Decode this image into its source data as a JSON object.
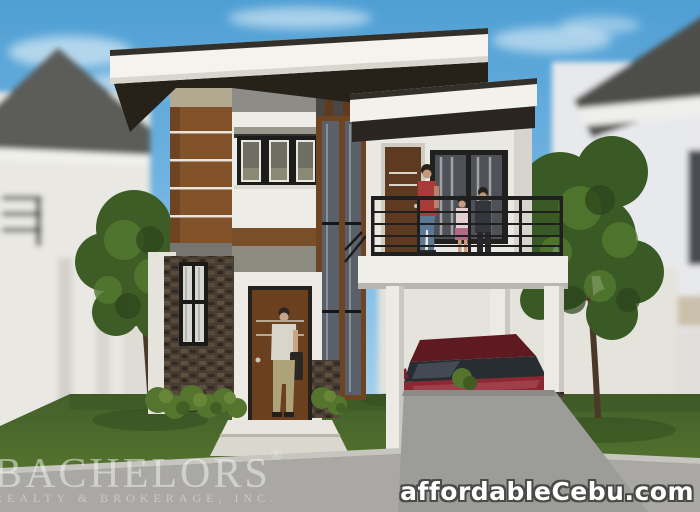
{
  "meta": {
    "type": "architectural-3d-rendering",
    "subject": "Two-storey modern single detached house with balcony, carport and dark red sedan, flanked by blurred neighboring houses and trees"
  },
  "watermarks": {
    "brand": "BACHELORS",
    "registered": "®",
    "brand_sub": "REALTY & BROKERAGE, INC.",
    "site": "affordableCebu.com"
  },
  "palette": {
    "sky_top": "#4f9fd4",
    "sky_bottom": "#b9ddf2",
    "roof_fascia": "#f4f3ee",
    "roof_underside": "#272219",
    "wall_white": "#edece6",
    "wood_accent": "#82522a",
    "beige_band": "#b3a890",
    "gray_panel": "#8e8c86",
    "stone": "#473c31",
    "glass": "#596069",
    "front_door": "#6a401f",
    "balcony_door": "#5d3a20",
    "railing": "#1f1f1f",
    "lawn": "#4e6d2c",
    "driveway": "#a9a8a4",
    "car_body": "#8c2630",
    "watermark_text": "#f8f8f4",
    "site_text": "#ffffff"
  },
  "scene": {
    "objects": [
      {
        "name": "sky",
        "desc": "blue sky with soft white clouds"
      },
      {
        "name": "neighbor-house-left",
        "desc": "blurred white house with gray pitched roof and dark balcony rails"
      },
      {
        "name": "neighbor-house-right",
        "desc": "blurred white house with dark gray roof wedge"
      },
      {
        "name": "tree-left",
        "desc": "green tree behind left side of house"
      },
      {
        "name": "tree-right",
        "desc": "large green tree in front of right neighbor"
      },
      {
        "name": "main-house",
        "desc": "two-storey modern house, white walls, flat roofs"
      },
      {
        "name": "flat-roof",
        "desc": "white fascia flat roof with dark underside"
      },
      {
        "name": "wood-slat-column",
        "desc": "brown wood panel column with white stripes"
      },
      {
        "name": "upper-window",
        "desc": "three-pane dark framed window with concrete sunshade"
      },
      {
        "name": "staircase-glazing",
        "desc": "full-height vertical glass strips with wood mullions"
      },
      {
        "name": "balcony",
        "desc": "second floor balcony over carport"
      },
      {
        "name": "balcony-railing",
        "desc": "black horizontal-bar metal railing"
      },
      {
        "name": "balcony-door",
        "desc": "brown door on balcony"
      },
      {
        "name": "balcony-window",
        "desc": "dark framed window with curtains"
      },
      {
        "name": "figure-woman",
        "desc": "woman in red shirt and jeans on balcony"
      },
      {
        "name": "figure-child",
        "desc": "child in pink outfit on balcony"
      },
      {
        "name": "figure-man-balcony",
        "desc": "person in dark clothes on balcony"
      },
      {
        "name": "carport",
        "desc": "open carport with white square posts"
      },
      {
        "name": "car-red-sedan",
        "desc": "dark red sedan parked in carport"
      },
      {
        "name": "stone-pillar",
        "desc": "stone-clad pillar with tall narrow curtain window"
      },
      {
        "name": "front-door",
        "desc": "brown front door with steps"
      },
      {
        "name": "figure-man-entrance",
        "desc": "man with briefcase at front door"
      },
      {
        "name": "entrance-steps",
        "desc": "white concrete entry steps"
      },
      {
        "name": "shrubs",
        "desc": "green shrubs along house base"
      },
      {
        "name": "lawn",
        "desc": "green grass lawn"
      },
      {
        "name": "driveway",
        "desc": "gray concrete driveway and sidewalk with curb"
      }
    ]
  }
}
